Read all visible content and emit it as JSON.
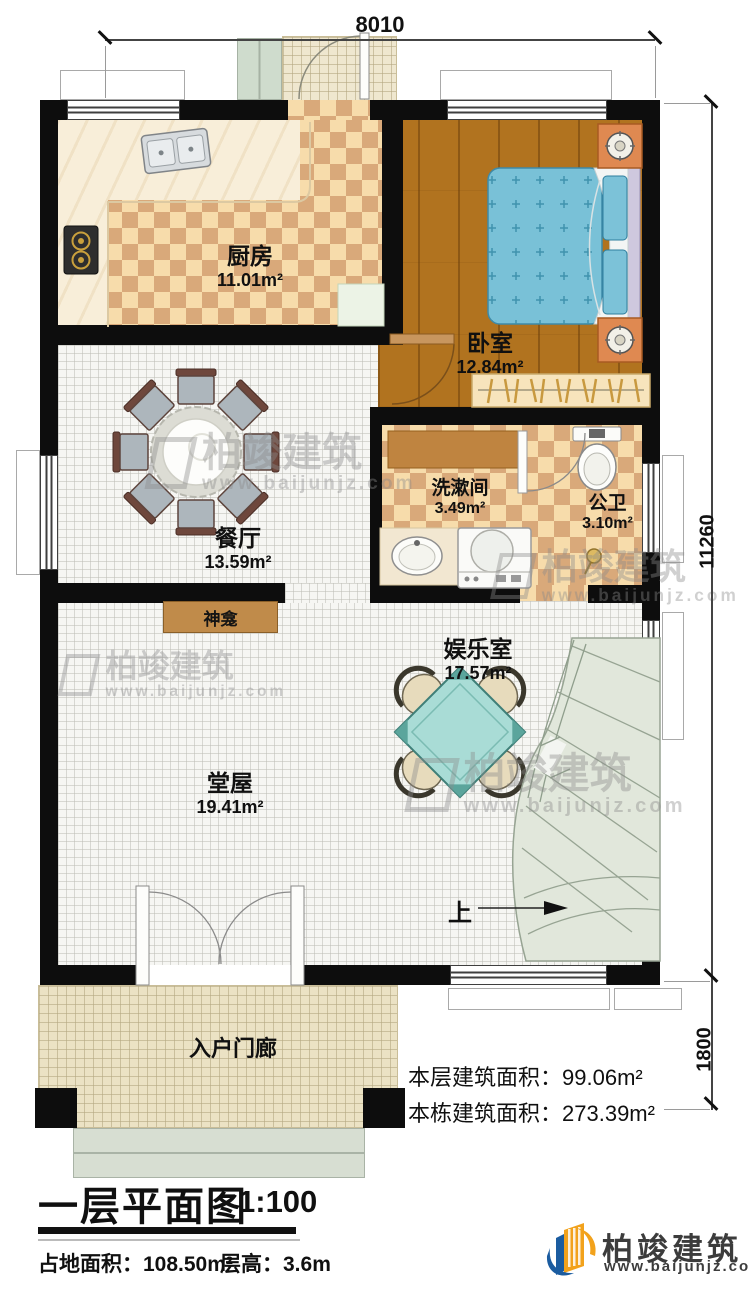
{
  "dimensions": {
    "top": "8010",
    "right_main": "11260",
    "right_porch": "1800"
  },
  "rooms": {
    "kitchen": {
      "name": "厨房",
      "area": "11.01m²"
    },
    "bedroom": {
      "name": "卧室",
      "area": "12.84m²"
    },
    "dining": {
      "name": "餐厅",
      "area": "13.59m²"
    },
    "washroom": {
      "name": "洗漱间",
      "area": "3.49m²"
    },
    "toilet": {
      "name": "公卫",
      "area": "3.10m²"
    },
    "entertainment": {
      "name": "娱乐室",
      "area": "17.57m²"
    },
    "hall": {
      "name": "堂屋",
      "area": "19.41m²"
    },
    "shrine": {
      "name": "神龛"
    },
    "porch": {
      "name": "入户门廊"
    },
    "stairs": {
      "up_label": "上"
    }
  },
  "area_info": {
    "floor_area_label": "本层建筑面积：",
    "floor_area_value": "99.06m²",
    "building_area_label": "本栋建筑面积：",
    "building_area_value": "273.39m²"
  },
  "title_block": {
    "title": "一层平面图",
    "scale": "1:100",
    "site_area": "占地面积：108.50m²",
    "floor_height": "层高：3.6m"
  },
  "logo": {
    "name": "柏竣建筑",
    "url": "www.baijunjz.com"
  },
  "watermark": {
    "name": "柏竣建筑",
    "url": "www.baijunjz.com"
  },
  "colors": {
    "wall": "#0d0d0d",
    "checker_light": "#f7dcab",
    "checker_dark": "#d9a97a",
    "wood": "#b1731f",
    "bed_blue": "#79c1d7",
    "table_teal": "#a9dcd6",
    "stair_green": "#e1e7db",
    "logo_orange": "#f2a21c",
    "logo_blue": "#1b5ca0"
  }
}
